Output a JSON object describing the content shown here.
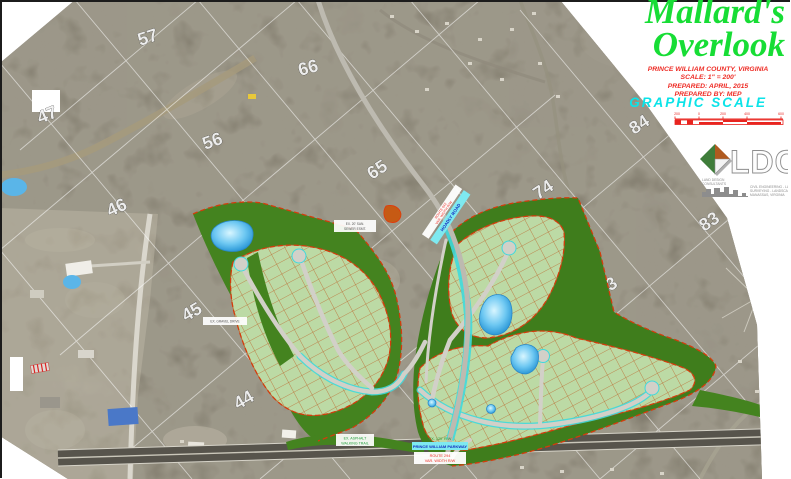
{
  "panel": {
    "title": {
      "line1": "Mallard's",
      "line2": "Overlook"
    },
    "info": {
      "lines": [
        "PRINCE WILLIAM COUNTY, VIRGINIA",
        "SCALE: 1\" = 200'",
        "PREPARED: APRIL, 2015",
        "PREPARED BY: MEP"
      ]
    },
    "graphic_scale": {
      "label": "GRAPHIC SCALE",
      "ticks": [
        "200",
        "0",
        "200",
        "400",
        "600"
      ]
    },
    "logo": {
      "initials": "LDC",
      "tagline_left1": "LAND DESIGN",
      "tagline_left2": "CONSULTANTS",
      "tagline_right1": "CIVIL ENGINEERING - LAND PLANNING",
      "tagline_right2": "SURVEYING - LANDSCAPE ARCHITECTURE",
      "tagline_right3": "MANASSAS, VIRGINIA"
    }
  },
  "map": {
    "grid_numbers": [
      {
        "label": "57"
      },
      {
        "label": "47"
      },
      {
        "label": "66"
      },
      {
        "label": "56"
      },
      {
        "label": "65"
      },
      {
        "label": "74"
      },
      {
        "label": "84"
      },
      {
        "label": "83"
      },
      {
        "label": "73"
      },
      {
        "label": "46"
      },
      {
        "label": "45"
      },
      {
        "label": "44"
      }
    ]
  },
  "labels": {
    "diagonal": {
      "name": "HOADLY ROAD",
      "route1": "ROUTE 642",
      "route2": "VAR. WIDTH R/W"
    },
    "highway": {
      "trail1": "EX. ASPHALT",
      "trail2": "WALKING TRAIL",
      "rw": "EX. 120' R/W",
      "name": "PRINCE WILLIAM PARKWAY",
      "route1": "ROUTE 294",
      "route2": "VAR. WIDTH R/W"
    },
    "site": [
      {
        "text": "EX. GRAVEL DRIVE"
      },
      {
        "line1": "EX. 20' SAN.",
        "line2": "SEWER ESMT."
      }
    ]
  },
  "colors": {
    "title_green": "#17dd35",
    "info_red": "#ee2d26",
    "scale_cyan": "#0be3e8",
    "scalebar_red": "#e8241f",
    "open_space_green": "#44831f",
    "lot_green": "#bcdaa5",
    "boundary_orange": "#d43c0c",
    "pond_blue": "#58c8f0",
    "road_cyan": "#3fd9dd"
  }
}
